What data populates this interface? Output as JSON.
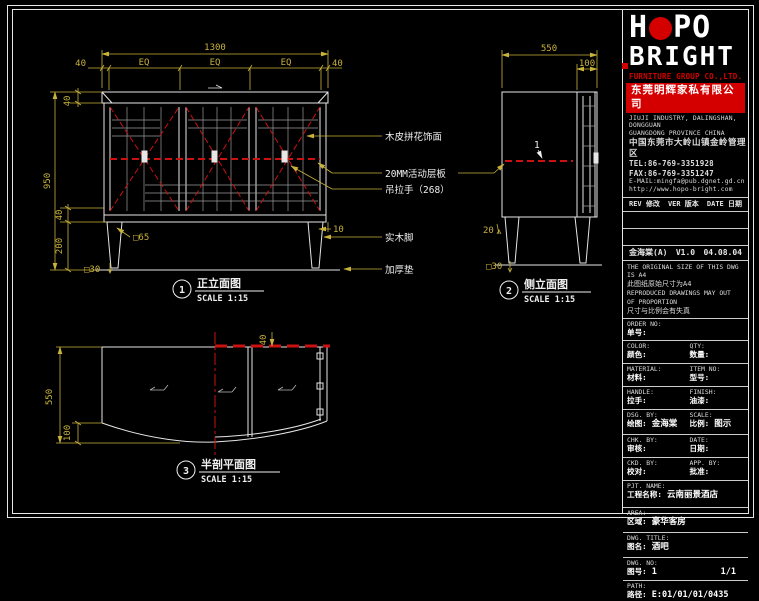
{
  "colors": {
    "background": "#000000",
    "line": "#e6e6e6",
    "dimension": "#c8b23c",
    "section_red": "#cc1111",
    "logo_red": "#d40000"
  },
  "logo": {
    "brand_h": "H",
    "brand_po": "PO",
    "brand_bottom": "BRIGHT",
    "subtitle": "FURNITURE GROUP CO.,LTD.",
    "company_cn": "东莞明辉家私有限公司"
  },
  "address": {
    "line1": "JIUJI INDUSTRY, DALINGSHAN, DONGGUAN",
    "line2": "GUANGDONG PROVINCE CHINA",
    "line3": "中国东莞市大岭山镇金岭管理区",
    "tel": "TEL:86-769-3351928",
    "fax": "FAX:86-769-3351247",
    "email": "E-MAIL:mingfa@pub.dgnet.gd.cn",
    "web": "http://www.hopo-bright.com"
  },
  "revision": {
    "header_rev": "REV 修改",
    "header_ver": "VER 版本",
    "header_date": "DATE 日期",
    "entry_name": "金海棠(A)",
    "entry_ver": "V1.0",
    "entry_date": "04.08.04"
  },
  "note": {
    "l1": "THE ORIGINAL SIZE OF THIS DWG IS A4",
    "l2": "此图纸原始尺寸为A4",
    "l3": "REPRODUCED DRAWINGS MAY OUT",
    "l4": "OF PROPORTION",
    "l5": "尺寸与比例会有失真"
  },
  "fields": {
    "order_en": "ORDER NO:",
    "order_cn": "单号:",
    "color_en": "COLOR:",
    "color_cn": "颜色:",
    "qty_en": "QTY:",
    "qty_cn": "数量:",
    "material_en": "MATERIAL:",
    "material_cn": "材料:",
    "item_en": "ITEM NO:",
    "item_cn": "型号:",
    "handle_en": "HANDLE:",
    "handle_cn": "拉手:",
    "finish_en": "FINISH:",
    "finish_cn": "油漆:",
    "dsg_en": "DSG. BY:",
    "dsg_cn": "绘图:",
    "dsg_val": "金海棠",
    "scale_en": "SCALE:",
    "scale_cn": "比例:",
    "scale_val": "图示",
    "chk_en": "CHK. BY:",
    "chk_cn": "审核:",
    "date_en": "DATE:",
    "date_cn": "日期:",
    "ckd_en": "CKD. BY:",
    "ckd_cn": "校对:",
    "app_en": "APP. BY:",
    "app_cn": "批准:",
    "pjt_en": "PJT. NAME:",
    "pjt_cn": "工程名称:",
    "pjt_val": "云南丽景酒店",
    "area_en": "AREA:",
    "area_cn": "区域:",
    "area_val": "豪华客房",
    "title_en": "DWG. TITLE:",
    "title_cn": "图名:",
    "title_val": "酒吧",
    "no_en": "DWG. NO:",
    "no_cn": "图号:",
    "no_val": "1",
    "no_val2": "1/1",
    "path_en": "PATH:",
    "path_cn": "路径:",
    "path_val": "E:01/01/01/0435"
  },
  "views": {
    "front": {
      "num": "1",
      "title": "正立面图",
      "scale": "SCALE 1:15",
      "dim_total": "1300",
      "dim_40l": "40",
      "dim_eq1": "EQ",
      "dim_eq2": "EQ",
      "dim_eq3": "EQ",
      "dim_40r": "40",
      "dim_top40": "40",
      "dim_950": "950",
      "dim_leg40": "40",
      "dim_200": "200",
      "dim_base30": "□30",
      "dim_65": "□65",
      "dim_10": "10"
    },
    "side": {
      "num": "2",
      "title": "侧立面图",
      "scale": "SCALE 1:15",
      "dim_550": "550",
      "dim_100": "100",
      "dim_20": "20",
      "dim_base30": "□30",
      "shelf_label": "1"
    },
    "plan": {
      "num": "3",
      "title": "半剖平面图",
      "scale": "SCALE 1:15",
      "dim_550": "550",
      "dim_100": "100",
      "dim_40": "40"
    }
  },
  "annotations": {
    "a1": "木皮拼花饰面",
    "a2": "20MM活动层板",
    "a3": "吊拉手（268）",
    "a4": "实木脚",
    "a5": "加厚垫"
  }
}
